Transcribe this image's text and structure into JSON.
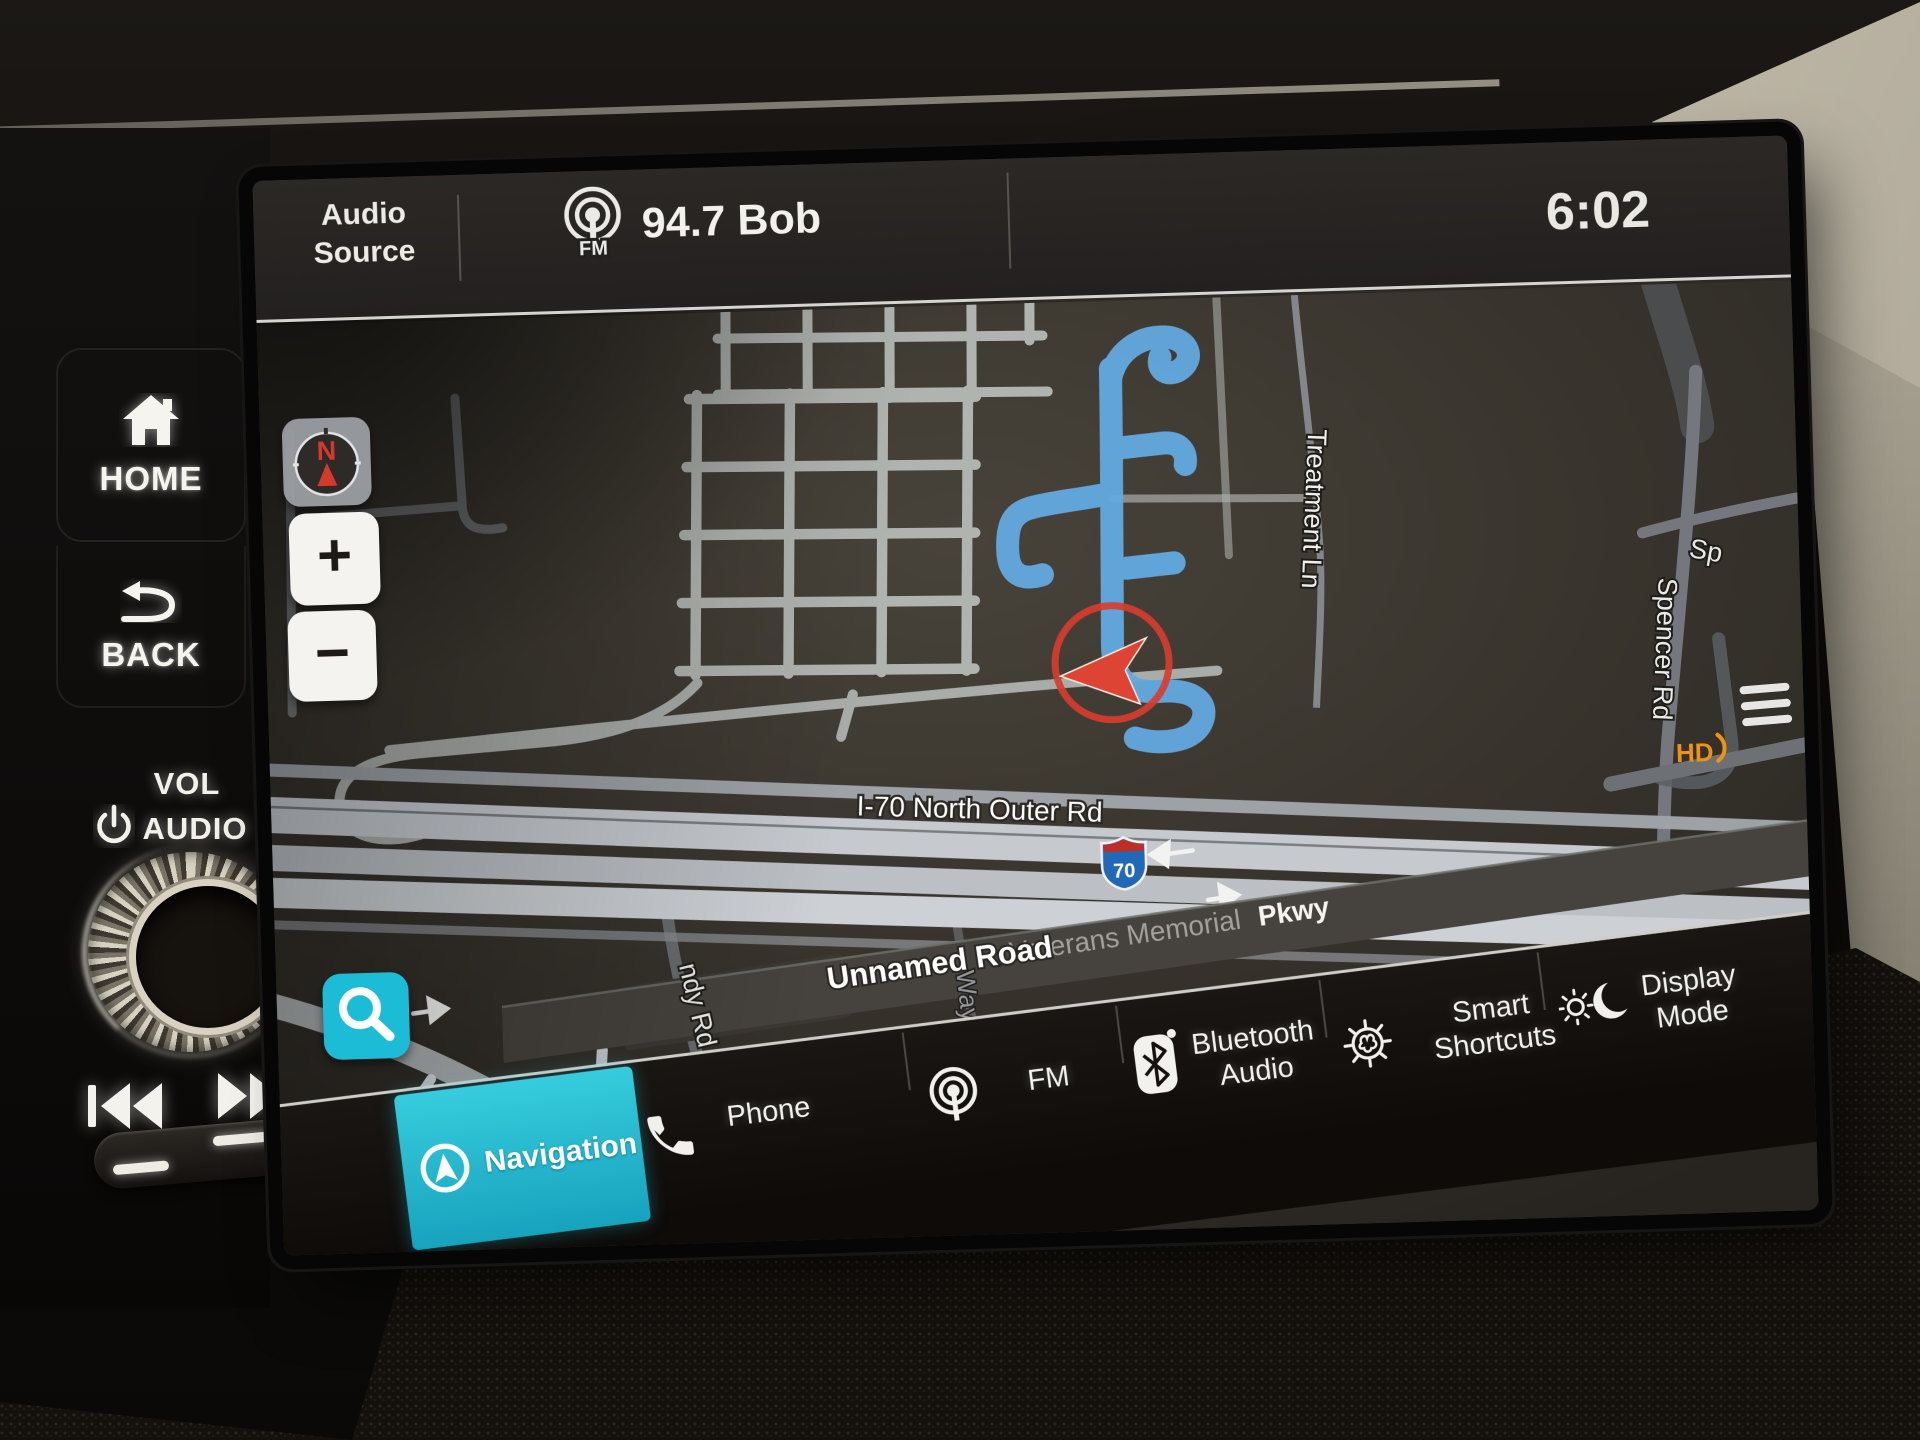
{
  "status_bar": {
    "audio_source": "Audio Source",
    "source_badge": "FM",
    "station": "94.7 Bob",
    "time": "6:02"
  },
  "physical_controls": {
    "home": "HOME",
    "back": "BACK",
    "volume": "VOL",
    "audio": "AUDIO"
  },
  "map": {
    "compass": "N",
    "zoom_in": "+",
    "zoom_out": "−",
    "hd_radio": "HD",
    "shield": {
      "route_number": "70"
    },
    "labels": {
      "i70_outer": "I-70 North Outer Rd",
      "unnamed": "Unnamed Road",
      "veterans": "Veterans Memorial",
      "pkwy": "Pkwy",
      "treatment": "Treatment Ln",
      "spencer": "Spencer Rd",
      "sp": "Sp",
      "ndy": "ndy Rd",
      "way": "Way"
    }
  },
  "bottom_bar": {
    "items": [
      {
        "label": "Navigation",
        "active": true
      },
      {
        "label": "Phone",
        "active": false
      },
      {
        "label": "FM",
        "active": false
      },
      {
        "label": "Bluetooth Audio",
        "active": false
      },
      {
        "label": "Smart Shortcuts",
        "active": false
      },
      {
        "label": "Display Mode",
        "active": false
      }
    ]
  },
  "colors": {
    "accent": "#1fbdd6",
    "route_blue": "#63a9e0",
    "position_red": "#d63c2e",
    "hd_orange": "#ef9214",
    "freeway": "#c6cacf",
    "road": "#b0b4b0"
  }
}
